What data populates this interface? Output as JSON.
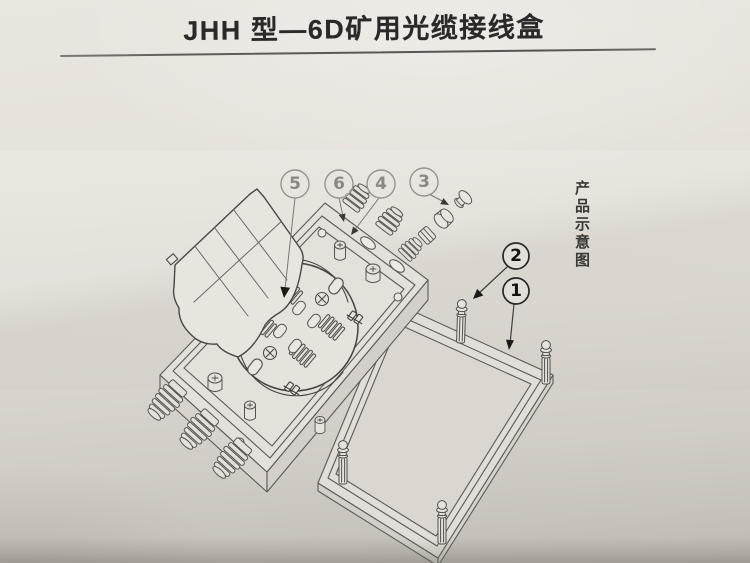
{
  "page": {
    "title": "JHH 型—6D矿用光缆接线盒",
    "side_label": "产品示意图"
  },
  "callouts": [
    {
      "id": "callout-5",
      "number": "5"
    },
    {
      "id": "callout-6",
      "number": "6"
    },
    {
      "id": "callout-4",
      "number": "4"
    },
    {
      "id": "callout-3",
      "number": "3"
    },
    {
      "id": "callout-2",
      "number": "2"
    },
    {
      "id": "callout-1",
      "number": "1"
    }
  ],
  "colors": {
    "paper_light": "#e9e5df",
    "paper_mid": "#dcd8d1",
    "paper_dark": "#c8c4bd",
    "line": "#5c5a56",
    "line_dark": "#413f3b",
    "ink_title": "#2b2927",
    "callout_faded": "#8b8783",
    "callout_dark": "#15130f"
  }
}
